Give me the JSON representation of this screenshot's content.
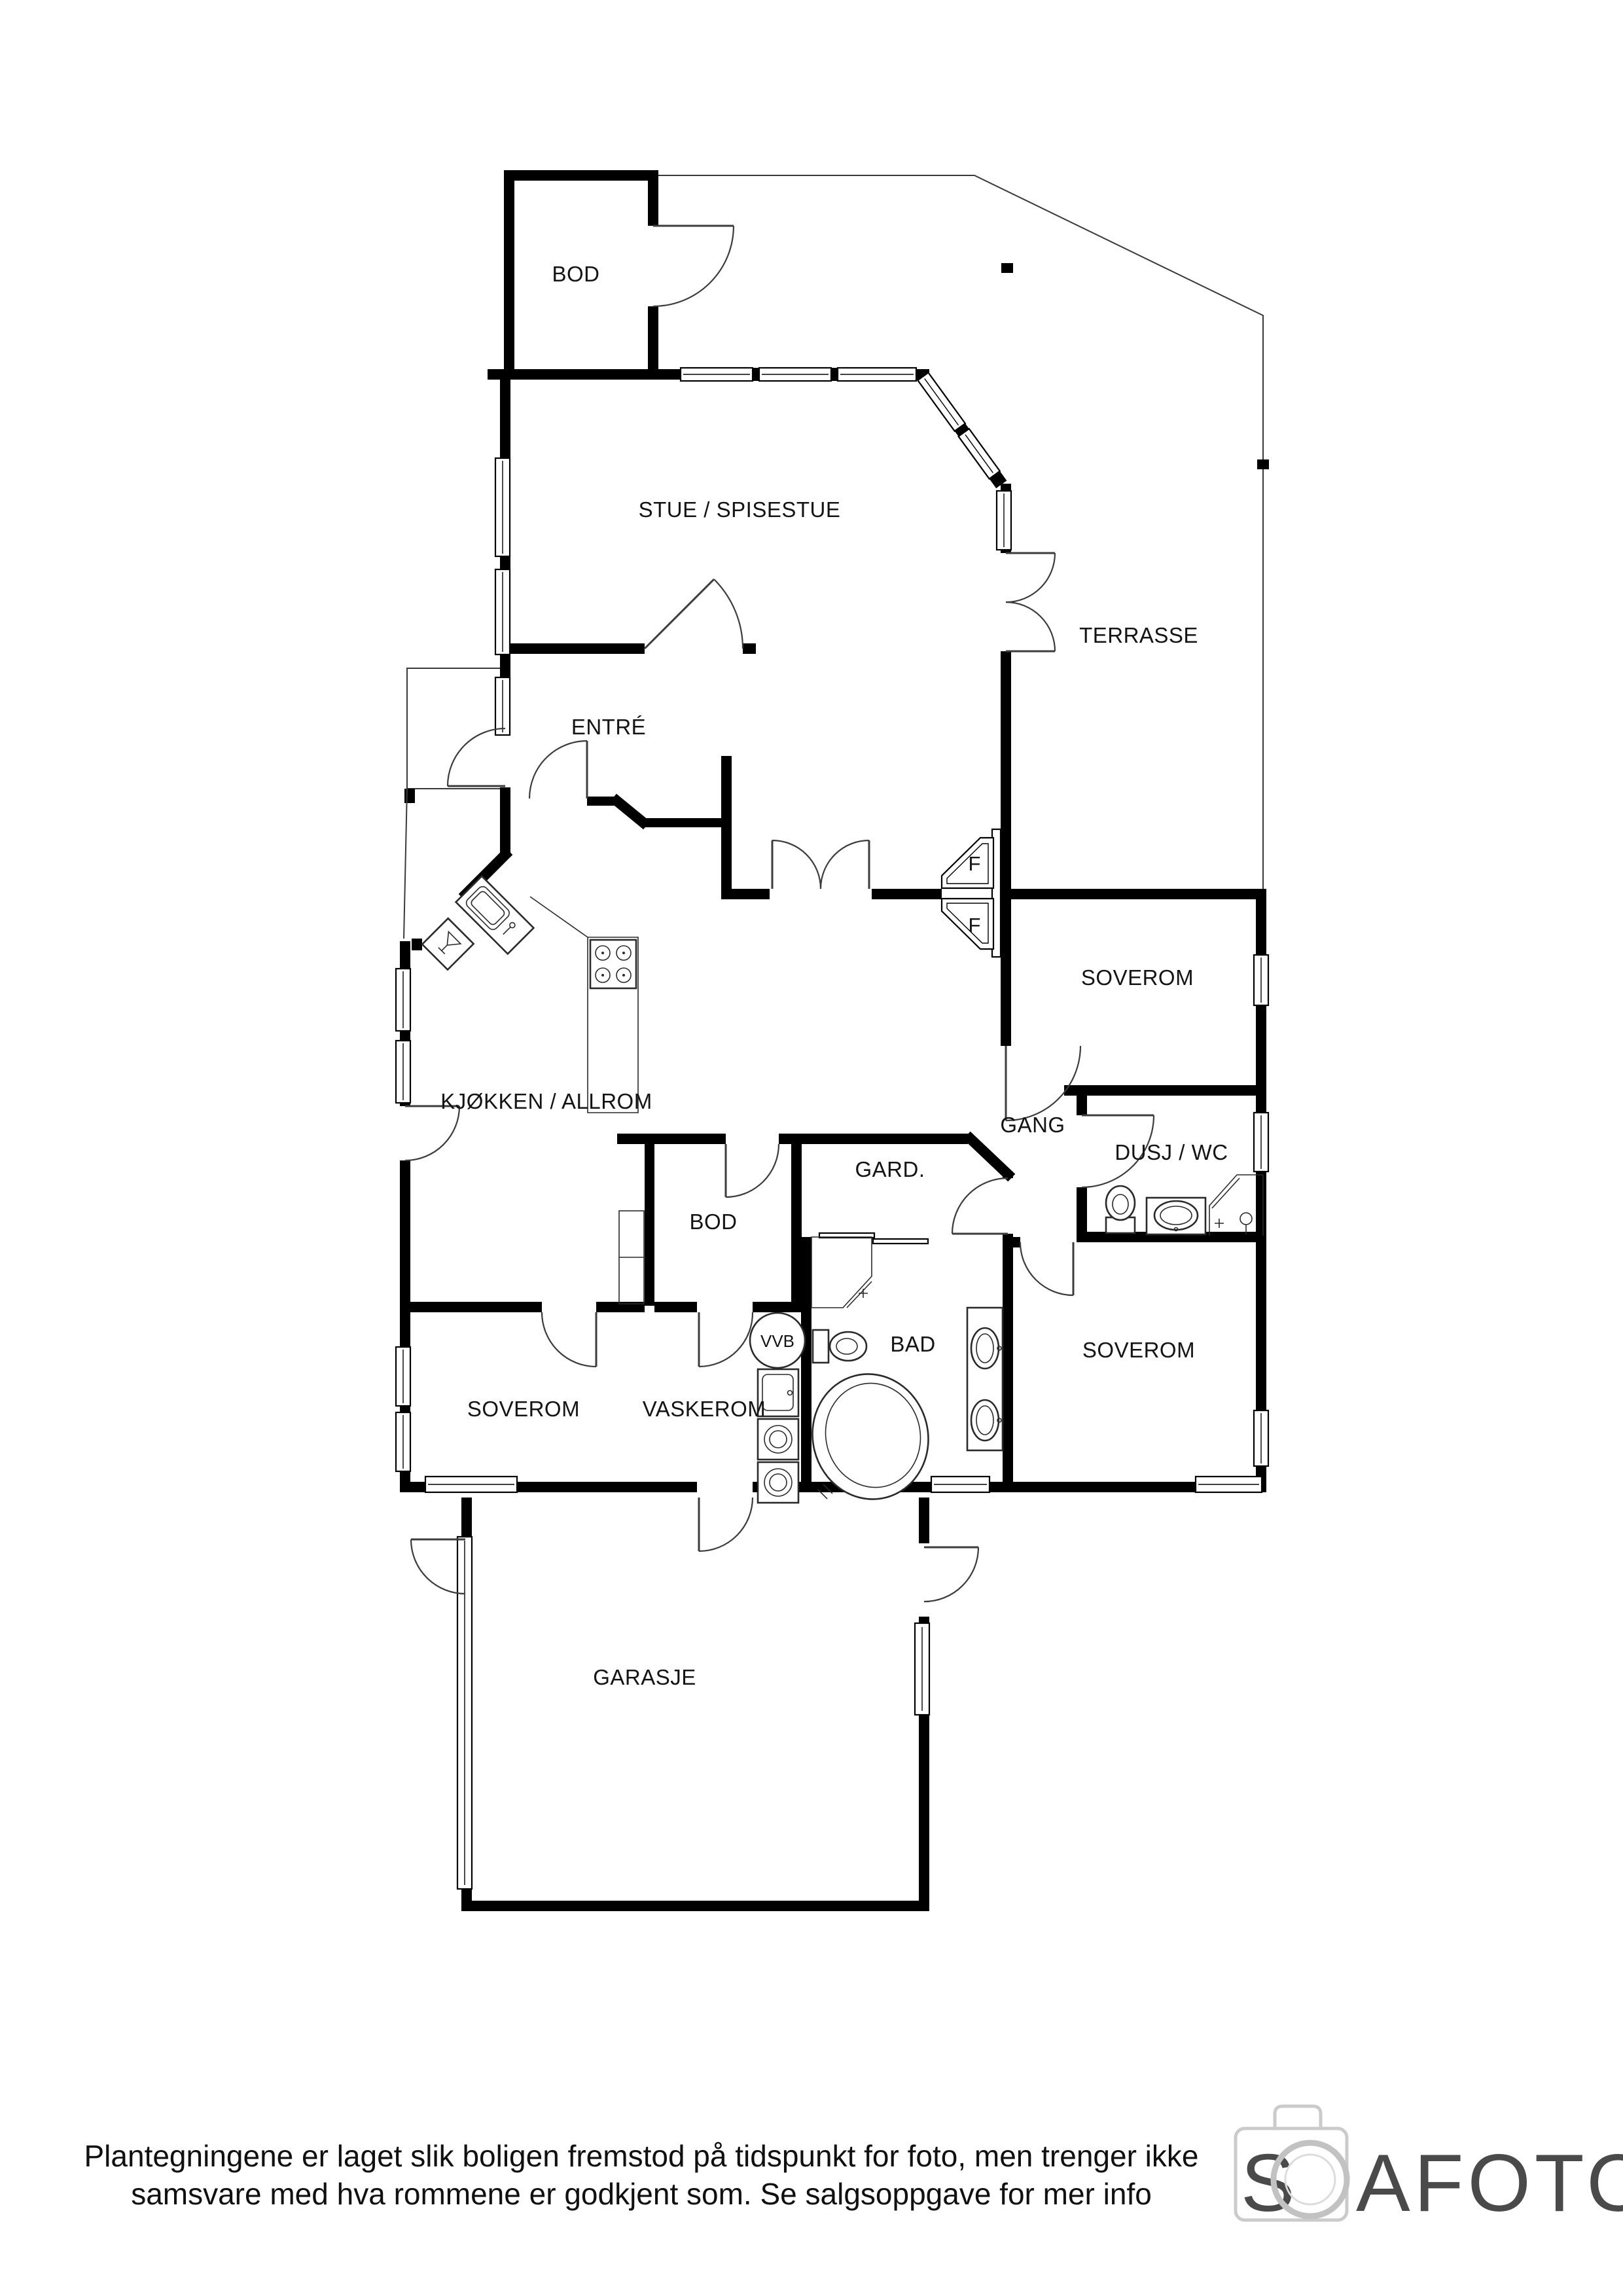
{
  "meta": {
    "type": "floor-plan",
    "background": "#ffffff",
    "colors": {
      "wall": "#000000",
      "thin_line": "#3a3a3a",
      "label": "#141414",
      "logo_text": "#4a4a4a",
      "logo_icon": "#cbcbcb"
    }
  },
  "rooms": [
    {
      "id": "bod-top",
      "label": "BOD"
    },
    {
      "id": "stue",
      "label": "STUE / SPISESTUE"
    },
    {
      "id": "terrasse",
      "label": "TERRASSE"
    },
    {
      "id": "entre",
      "label": "ENTRÉ"
    },
    {
      "id": "soverom-ost",
      "label": "SOVEROM"
    },
    {
      "id": "kjokken",
      "label": "KJØKKEN / ALLROM"
    },
    {
      "id": "gang",
      "label": "GANG"
    },
    {
      "id": "gard",
      "label": "GARD."
    },
    {
      "id": "dusj-wc",
      "label": "DUSJ / WC"
    },
    {
      "id": "bod-indre",
      "label": "BOD"
    },
    {
      "id": "bad",
      "label": "BAD"
    },
    {
      "id": "soverom-vest",
      "label": "SOVEROM"
    },
    {
      "id": "vaskerom",
      "label": "VASKEROM"
    },
    {
      "id": "soverom-sor",
      "label": "SOVEROM"
    },
    {
      "id": "garasje",
      "label": "GARASJE"
    }
  ],
  "window_markers": [
    {
      "label": "F"
    },
    {
      "label": "F"
    }
  ],
  "fixtures": {
    "water_heater_label": "VVB"
  },
  "disclaimer": {
    "line1": "Plantegningene er laget slik boligen fremstod på tidspunkt for foto, men trenger ikke",
    "line2": "samsvare med hva rommene er godkjent som. Se salgsoppgave for mer info"
  },
  "logo": {
    "full": "SOAFOTO",
    "part1": "S",
    "part2": "AFOTO"
  }
}
